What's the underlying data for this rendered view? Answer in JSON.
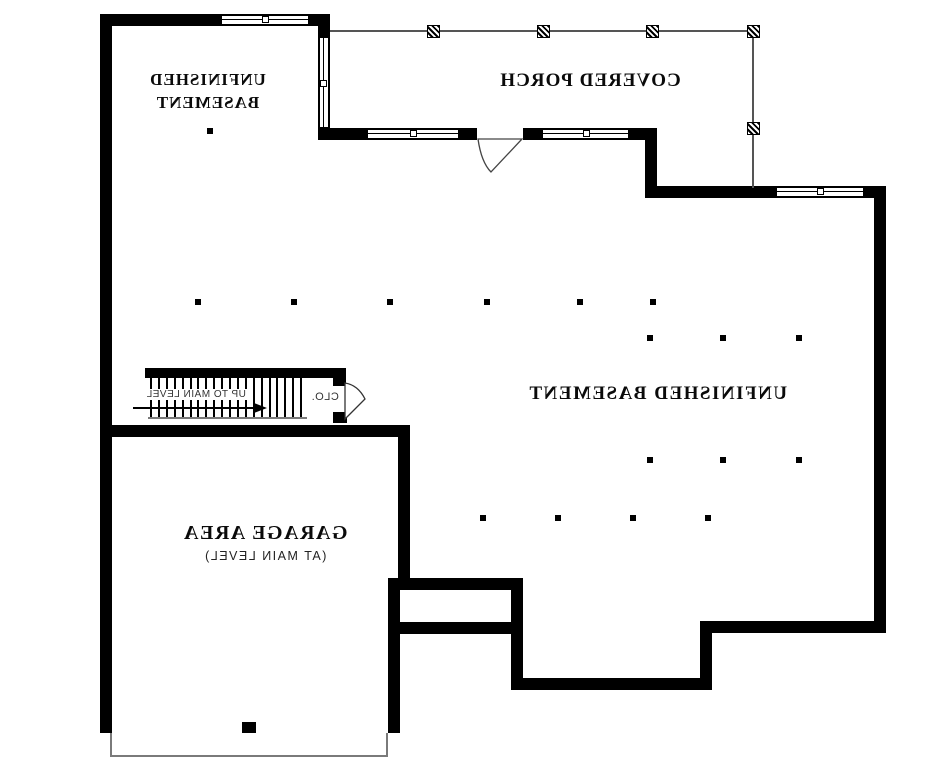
{
  "plan": {
    "type": "basement floor plan (mirrored print)",
    "text_mirrored": true,
    "labels": {
      "basement_upper_line1": "UNFINISHED",
      "basement_upper_line2": "BASEMENT",
      "covered_porch": "COVERED PORCH",
      "basement_main": "UNFINISHED BASEMENT",
      "garage_area": "GARAGE AREA",
      "garage_area_sub": "(AT MAIN LEVEL)",
      "stair_direction": "UP TO MAIN LEVEL",
      "closet": "CLO."
    },
    "colors": {
      "wall": "#000000",
      "thin_line": "#7a7a7a",
      "background": "#ffffff"
    },
    "column_dots": [
      [
        198,
        302
      ],
      [
        294,
        302
      ],
      [
        390,
        302
      ],
      [
        487,
        302
      ],
      [
        580,
        302
      ],
      [
        653,
        302
      ],
      [
        650,
        338
      ],
      [
        723,
        338
      ],
      [
        799,
        338
      ],
      [
        650,
        460
      ],
      [
        723,
        460
      ],
      [
        799,
        460
      ],
      [
        483,
        518
      ],
      [
        558,
        518
      ],
      [
        633,
        518
      ],
      [
        708,
        518
      ],
      [
        210,
        131
      ]
    ],
    "porch_posts": [
      [
        433,
        31
      ],
      [
        543,
        31
      ],
      [
        652,
        31
      ],
      [
        753,
        31
      ],
      [
        753,
        128
      ]
    ],
    "stair_treads": {
      "x": 150,
      "y": 378,
      "height": 41,
      "count": 20,
      "step": 7.9
    }
  }
}
